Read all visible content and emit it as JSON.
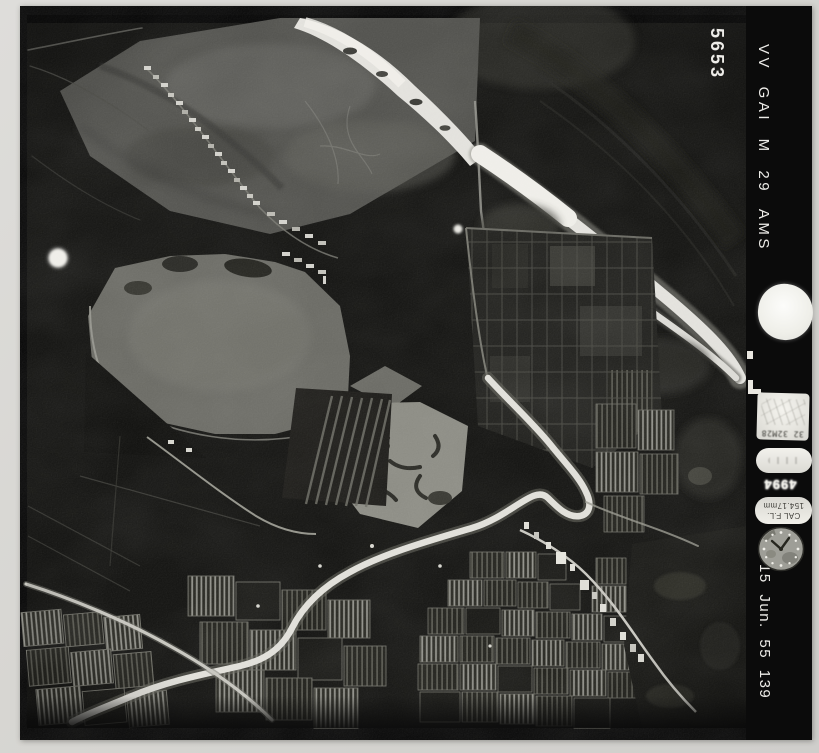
{
  "scan": {
    "frame_number": "5653",
    "mission_code": "VV GAI M 29 AMS",
    "date_stamp": "15 Jun. 55 139",
    "instrument_panel": {
      "altimeter_text": "32 32M28",
      "counter_text": "4994",
      "focal_plate_line1": "CAL F.L.",
      "focal_plate_line2": "154.17mm"
    },
    "icons": {
      "film_marker_circle": "white-circle-marker",
      "punch_hole": "white-punch-hole",
      "fiducial_dot": "small-white-dot",
      "edge_marks": "white-edge-ticks",
      "clock": "clock-dial"
    },
    "colors": {
      "scan_background": "#d6d5d1",
      "paper_black": "#0c0c0c",
      "stamp_text_white": "#edece8",
      "photo_highlight": "#e4e3df",
      "photo_midtone": "#5f5f5d",
      "photo_shadow": "#171715"
    }
  }
}
